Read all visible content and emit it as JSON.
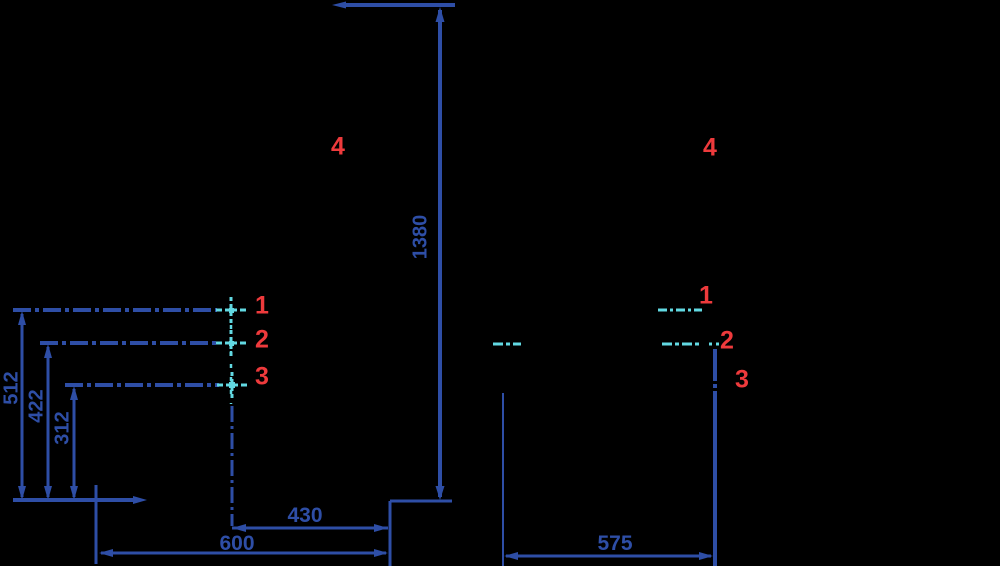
{
  "drawing": {
    "background": "#000000",
    "colors": {
      "line_blue": "#2e4ea6",
      "center_mark_cyan": "#62d9e2",
      "callout_red": "#ee3a3c"
    },
    "left_view": {
      "dims": {
        "overall_height": "1380",
        "level_1_height": "512",
        "level_2_height": "422",
        "level_3_height": "312",
        "depth_total": "600",
        "depth_partial": "430"
      },
      "callouts": {
        "c1": "1",
        "c2": "2",
        "c3": "3",
        "c4": "4"
      }
    },
    "right_view": {
      "dims": {
        "overall_width": "575"
      },
      "callouts": {
        "c1": "1",
        "c2": "2",
        "c3": "3",
        "c4": "4"
      }
    }
  }
}
